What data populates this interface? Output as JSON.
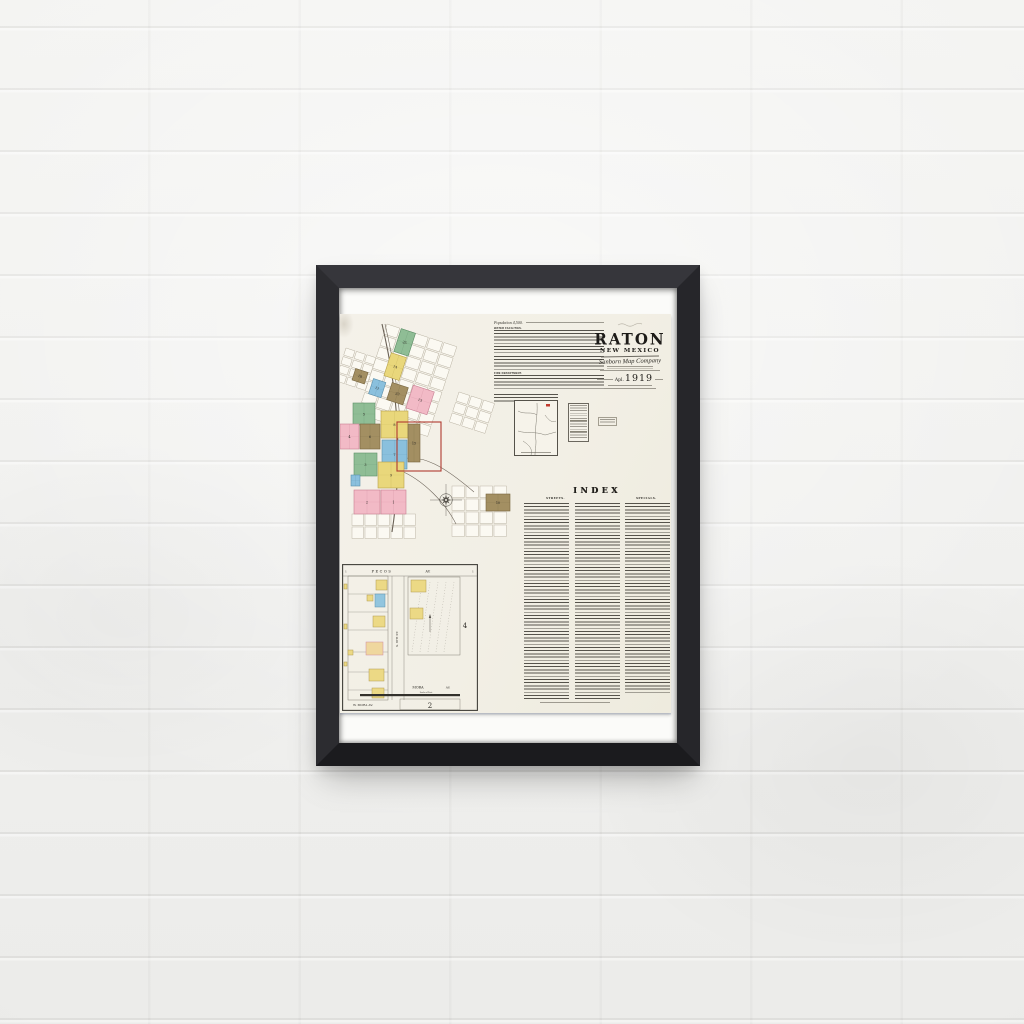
{
  "scene": {
    "wall_color": "#f0f0ee",
    "frame_color": "#232327",
    "matte_color": "#fbfbf9",
    "paper_color": "#f2efe5"
  },
  "poster": {
    "title_block": {
      "city": "RATON",
      "state_word1": "NEW",
      "state_word2": "MEXICO",
      "company": "Sanborn Map Company",
      "date_prefix": "Apl.",
      "date_year": "1919"
    },
    "notes": {
      "population": "Population 4,500.",
      "sections": [
        "WATER FACILITIES.",
        "FIRE DEPARTMENT."
      ]
    },
    "index": {
      "title": "INDEX",
      "columns": [
        "STREETS.",
        "SPECIALS."
      ]
    },
    "city_map": {
      "grid_stroke": "#b7b0a0",
      "cell_fill": "#fbf9f2",
      "palette": {
        "green": {
          "f": "#8fbd95",
          "s": "#5d8f68"
        },
        "yellow": {
          "f": "#e9d77b",
          "s": "#b7a14a"
        },
        "pink": {
          "f": "#f2bac6",
          "s": "#c87f93"
        },
        "brown": {
          "f": "#a38f62",
          "s": "#77653f"
        },
        "blue": {
          "f": "#8ac0dd",
          "s": "#5b8fab"
        }
      },
      "clusters": [
        {
          "tx": 47,
          "ty": 6,
          "rot": 18,
          "rows": 8,
          "cols": 5,
          "cw": 15,
          "ch": 12
        },
        {
          "tx": 6,
          "ty": 30,
          "rot": 18,
          "rows": 4,
          "cols": 3,
          "cw": 11,
          "ch": 9
        },
        {
          "tx": 12,
          "ty": 196,
          "rot": 0,
          "rows": 2,
          "cols": 5,
          "cw": 13,
          "ch": 13
        },
        {
          "tx": 112,
          "ty": 168,
          "rot": 0,
          "rows": 4,
          "cols": 4,
          "cw": 14,
          "ch": 13
        },
        {
          "tx": 119,
          "ty": 74,
          "rot": 18,
          "rows": 3,
          "cols": 3,
          "cw": 13,
          "ch": 11
        }
      ],
      "rotated_group": {
        "tx": 47,
        "ty": 6,
        "rot": 18,
        "blocks": [
          {
            "x": 15,
            "y": 0,
            "w": 15,
            "h": 24,
            "c": "green",
            "n": "25"
          },
          {
            "x": 13,
            "y": 26,
            "w": 16,
            "h": 24,
            "c": "yellow",
            "n": "14"
          },
          {
            "x": 4,
            "y": 56,
            "w": 13,
            "h": 16,
            "c": "blue",
            "n": "11"
          },
          {
            "x": 23,
            "y": 54,
            "w": 17,
            "h": 18,
            "c": "brown",
            "n": "23"
          },
          {
            "x": 44,
            "y": 50,
            "w": 22,
            "h": 24,
            "c": "pink",
            "n": "13"
          },
          {
            "x": -16,
            "y": 52,
            "w": 13,
            "h": 12,
            "c": "brown",
            "n": "18"
          }
        ]
      },
      "blocks": [
        {
          "x": 13,
          "y": 85,
          "w": 22,
          "h": 22,
          "c": "green",
          "n": "5"
        },
        {
          "x": 41,
          "y": 93,
          "w": 27,
          "h": 27,
          "c": "yellow",
          "n": "8"
        },
        {
          "x": 0,
          "y": 106,
          "w": 19,
          "h": 25,
          "c": "pink",
          "n": "4"
        },
        {
          "x": 20,
          "y": 106,
          "w": 20,
          "h": 25,
          "c": "brown",
          "n": "6"
        },
        {
          "x": 42,
          "y": 122,
          "w": 25,
          "h": 29,
          "c": "blue",
          "n": "7"
        },
        {
          "x": 68,
          "y": 106,
          "w": 12,
          "h": 38,
          "c": "brown",
          "n": "15"
        },
        {
          "x": 14,
          "y": 135,
          "w": 23,
          "h": 23,
          "c": "green",
          "n": "3"
        },
        {
          "x": 38,
          "y": 144,
          "w": 26,
          "h": 26,
          "c": "yellow",
          "n": "9"
        },
        {
          "x": 11,
          "y": 157,
          "w": 9,
          "h": 11,
          "c": "blue",
          "n": ""
        },
        {
          "x": 14,
          "y": 172,
          "w": 26,
          "h": 24,
          "c": "pink",
          "n": "2"
        },
        {
          "x": 41,
          "y": 172,
          "w": 25,
          "h": 24,
          "c": "pink",
          "n": "1"
        },
        {
          "x": 146,
          "y": 176,
          "w": 24,
          "h": 17,
          "c": "brown",
          "n": "10"
        }
      ],
      "red_rect": {
        "x": 57,
        "y": 104,
        "w": 44,
        "h": 49,
        "color": "#b03a30"
      },
      "rail_paths": [
        "M42,6 C50,40 55,72 57,104 C59,140 58,176 52,214",
        "M45,6 C53,40 58,72 60,104",
        "M58,142 C82,134 106,150 134,174",
        "M59,152 C84,162 106,186 116,206"
      ],
      "compass": {
        "cx": 106,
        "cy": 182,
        "r": 5
      }
    },
    "environs": {
      "roads": [
        "M3,10 C10,14 16,10 22,14",
        "M22,2 C23,16 19,28 21,40 C21,46 20,50 20,54",
        "M3,30 C12,33 20,30 30,34 L41,31",
        "M30,14 C34,20 38,22 41,20",
        "M8,40 C14,44 18,48 16,54"
      ],
      "marker": {
        "x": 31,
        "y": 3,
        "w": 4,
        "h": 2.5,
        "color": "#c13b2e"
      }
    },
    "detail_inset": {
      "labels": {
        "top_street": "PECOS",
        "top_av": "AV.",
        "mid_street": "MORA",
        "mid_av": "AV.",
        "bottom_street": "W. MORA AV.",
        "vert_street": "S. 6TH ST.",
        "scale": "Scale of Feet",
        "num_right": "4",
        "num_bottom": "2",
        "corner_left": "1",
        "corner_right": "1"
      },
      "palette": {
        "yellow": {
          "f": "#ecd985",
          "s": "#b09a4e"
        },
        "blue": {
          "f": "#92c5de",
          "s": "#5b8fab"
        },
        "pinkish": {
          "f": "#efd79e",
          "s": "#cf8aa0"
        }
      },
      "lot_lines_y": [
        30,
        48,
        66,
        88,
        108,
        126
      ],
      "buildings": [
        {
          "x": 34,
          "y": 16,
          "w": 11,
          "h": 10,
          "c": "yellow"
        },
        {
          "x": 25,
          "y": 31,
          "w": 6,
          "h": 6,
          "c": "yellow"
        },
        {
          "x": 33,
          "y": 30,
          "w": 10,
          "h": 13,
          "c": "blue"
        },
        {
          "x": 31,
          "y": 52,
          "w": 12,
          "h": 11,
          "c": "yellow"
        },
        {
          "x": 24,
          "y": 78,
          "w": 17,
          "h": 13,
          "c": "pinkish"
        },
        {
          "x": 6,
          "y": 86,
          "w": 5,
          "h": 5,
          "c": "yellow"
        },
        {
          "x": 27,
          "y": 105,
          "w": 15,
          "h": 12,
          "c": "yellow"
        },
        {
          "x": 30,
          "y": 124,
          "w": 12,
          "h": 10,
          "c": "yellow"
        },
        {
          "x": 69,
          "y": 16,
          "w": 15,
          "h": 12,
          "c": "yellow"
        },
        {
          "x": 68,
          "y": 44,
          "w": 13,
          "h": 11,
          "c": "yellow"
        },
        {
          "x": 2,
          "y": 20,
          "w": 3,
          "h": 5,
          "c": "yellow"
        },
        {
          "x": 2,
          "y": 60,
          "w": 3,
          "h": 5,
          "c": "yellow"
        },
        {
          "x": 2,
          "y": 98,
          "w": 3,
          "h": 4,
          "c": "yellow"
        }
      ]
    }
  }
}
